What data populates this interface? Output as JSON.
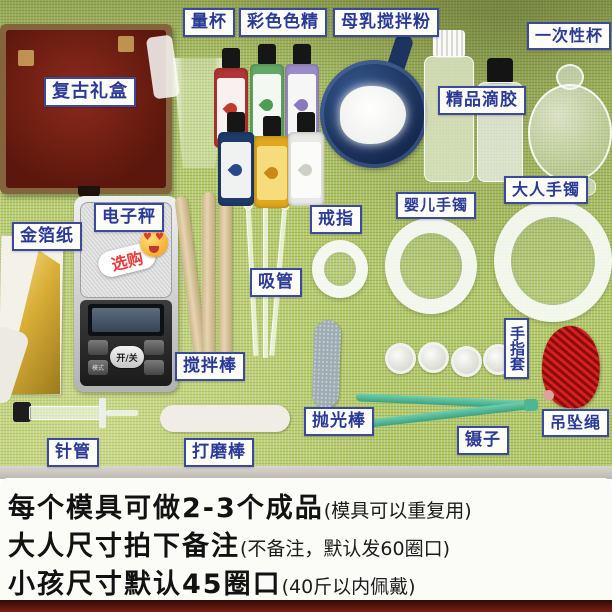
{
  "annotations": {
    "measuring_cup": "量杯",
    "color_pigment": "彩色色精",
    "milk_stir_powder": "母乳搅拌粉",
    "disposable_cup": "一次性杯",
    "vintage_gift_box": "复古礼盒",
    "premium_resin": "精品滴胶",
    "adult_bracelet": "大人手镯",
    "baby_bracelet": "婴儿手镯",
    "ring": "戒指",
    "gold_foil": "金箔纸",
    "electronic_scale": "电子秤",
    "optional_badge": "选购",
    "pipette": "吸管",
    "stir_stick": "搅拌棒",
    "finger_cots": "手指套",
    "pendant_rope": "吊坠绳",
    "polish_stick": "抛光棒",
    "tweezers": "镊子",
    "syringe": "针管",
    "sanding_stick": "打磨棒"
  },
  "scale": {
    "power_button": "开/关",
    "mode_button": "模式"
  },
  "footer": {
    "lines": [
      {
        "main": "每个模具可做2-3个成品",
        "note": "(模具可以重复用)"
      },
      {
        "main": "大人尺寸拍下备注",
        "note": "(不备注，默认发60圈口)"
      },
      {
        "main": "小孩尺寸默认45圈口",
        "note": "(40斤以内佩戴)"
      }
    ]
  },
  "colors": {
    "mat_green": "#b4ca6a",
    "label_border": "#3b4a9e",
    "label_text": "#2b3a96",
    "badge_text": "#e63c3c",
    "footer_text": "#121212",
    "bottom_strip": "#5a150c",
    "gift_box": "#6b1f12",
    "scoop_blue": "#16294f"
  }
}
